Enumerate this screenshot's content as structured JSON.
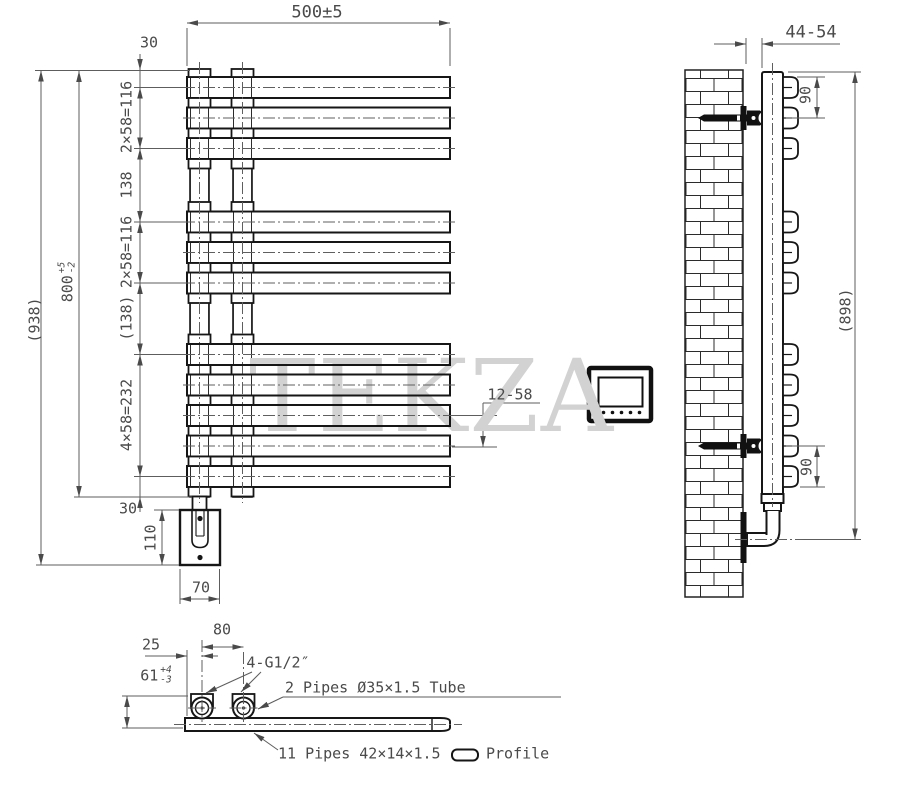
{
  "watermark": "TEKZA",
  "front_view": {
    "dim_width": "500±5",
    "dim_offset_top": "30",
    "dim_pitch_top": "2×58=116",
    "dim_gap_top": "138",
    "dim_pitch_mid": "2×58=116",
    "dim_gap_mid": "(138)",
    "dim_pitch_bottom": "4×58=232",
    "dim_offset_bottom": "30",
    "dim_height_value": "800",
    "dim_height_tol_plus": "+5",
    "dim_height_tol_minus": "-2",
    "dim_overall_height": "(938)",
    "dim_bracket_box_height": "110",
    "dim_bracket_box_width": "70",
    "dim_hook_spacing": "12-58"
  },
  "side_view": {
    "dim_wall_clearance": "44-54",
    "dim_bracket_top": "90",
    "dim_bracket_bottom": "90",
    "dim_overall_height": "(898)"
  },
  "section_view": {
    "dim_edge_to_tube": "25",
    "dim_tube_spacing": "80",
    "dim_depth_value": "61",
    "dim_depth_tol_plus": "+4",
    "dim_depth_tol_minus": "-3",
    "label_thread": "4-G1/2″",
    "note_tubes": "2 Pipes Ø35×1.5 Tube",
    "note_pipes": "11 Pipes 42×14×1.5",
    "note_profile": "Profile"
  }
}
